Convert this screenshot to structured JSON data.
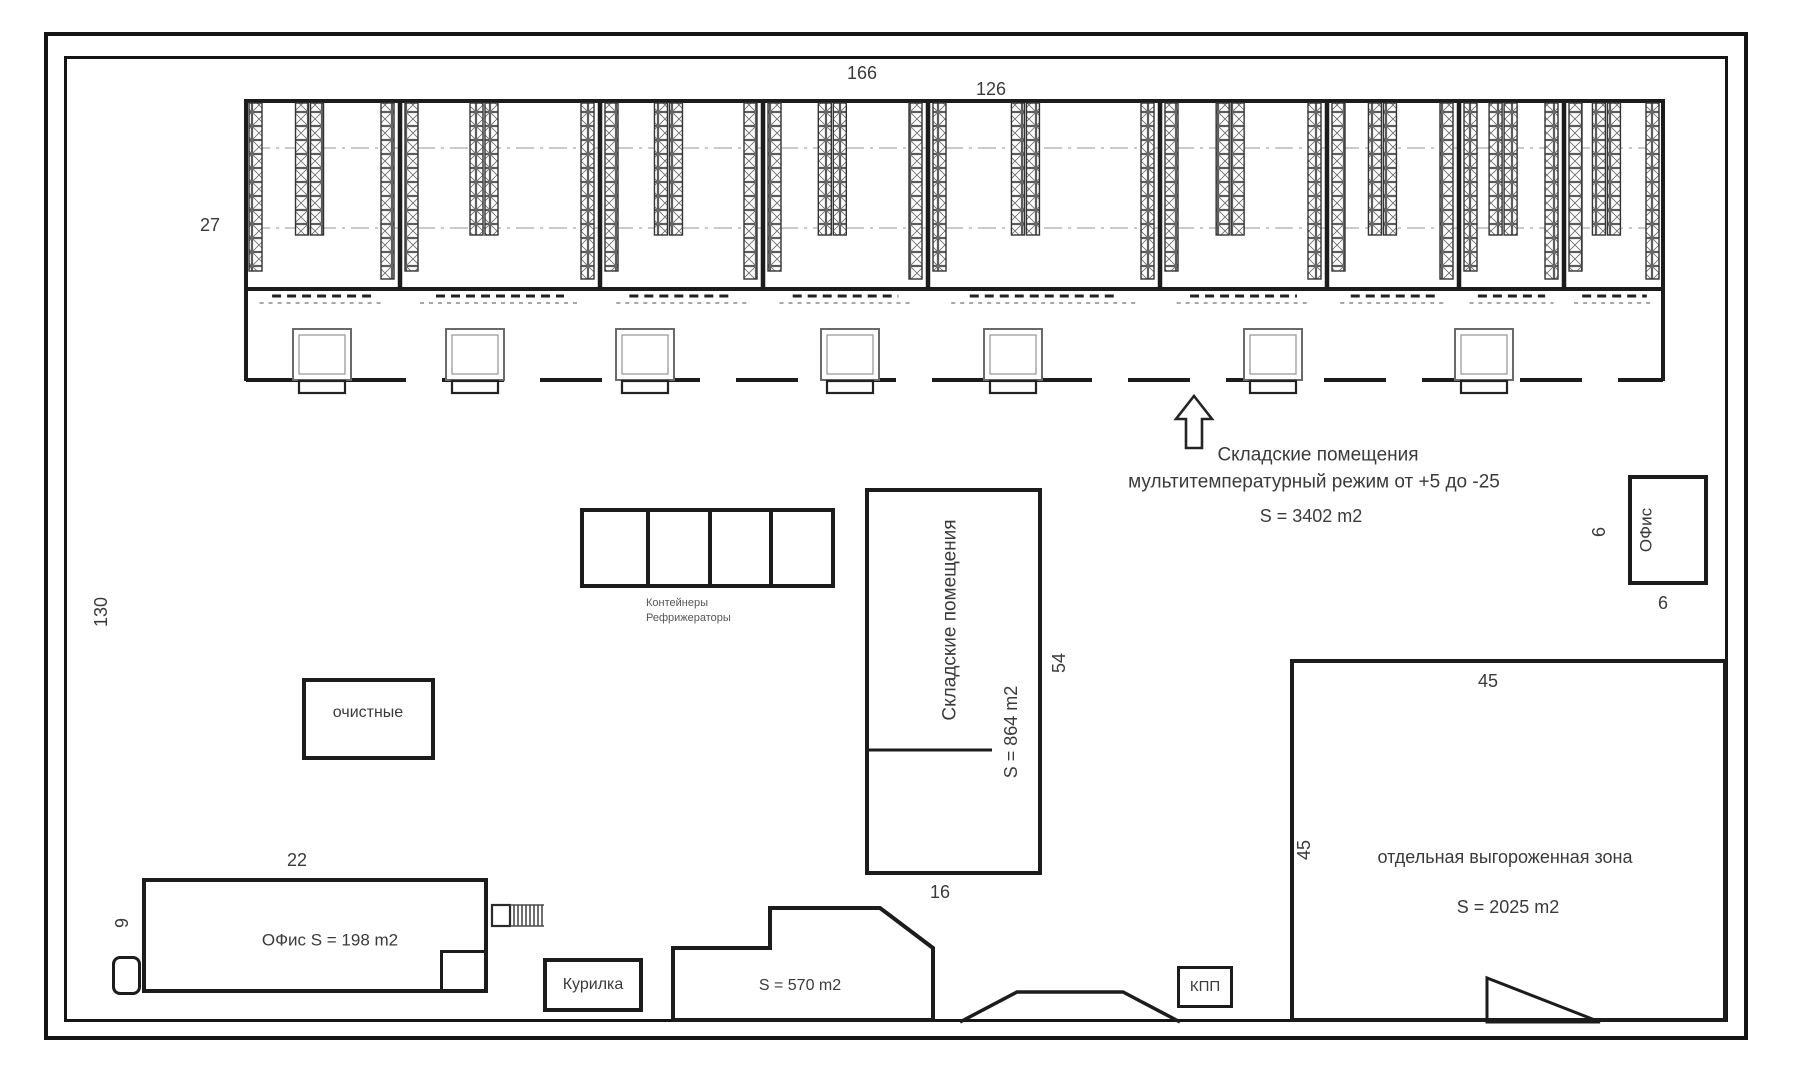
{
  "plan_title": "Warehouse site plan",
  "colors": {
    "line": "#1c1c1c",
    "text": "#3a3a3a",
    "background": "#ffffff",
    "light_line": "#9b9b9b"
  },
  "dimensions": {
    "warehouse_top_width": "166",
    "warehouse_top_width_2": "126",
    "warehouse_depth": "27",
    "site_left_height": "130",
    "office_left_width": "22",
    "office_left_depth": "9",
    "mid_storage_height": "54",
    "mid_storage_width": "16",
    "zone_top": "45",
    "zone_side": "45",
    "office_right_side": "6",
    "office_right_bottom": "6"
  },
  "warehouse_note": {
    "line1": "Складские помещения",
    "line2": "мультитемпературный режим от +5 до -25",
    "area": "S = 3402 m2"
  },
  "buildings": {
    "containers_line1": "Контейнеры",
    "containers_line2": "Рефрижераторы",
    "treatment": "очистные",
    "mid_storage_name": "Складские помещения",
    "mid_storage_area": "S = 864 m2",
    "office_left": "ОФис  S = 198 m2",
    "smoking_room": "Курилка",
    "yard_area": "S = 570 m2",
    "checkpoint": "КПП",
    "zone_name": "отдельная выгороженная зона",
    "zone_area": "S = 2025 m2",
    "office_right": "ОФис"
  }
}
